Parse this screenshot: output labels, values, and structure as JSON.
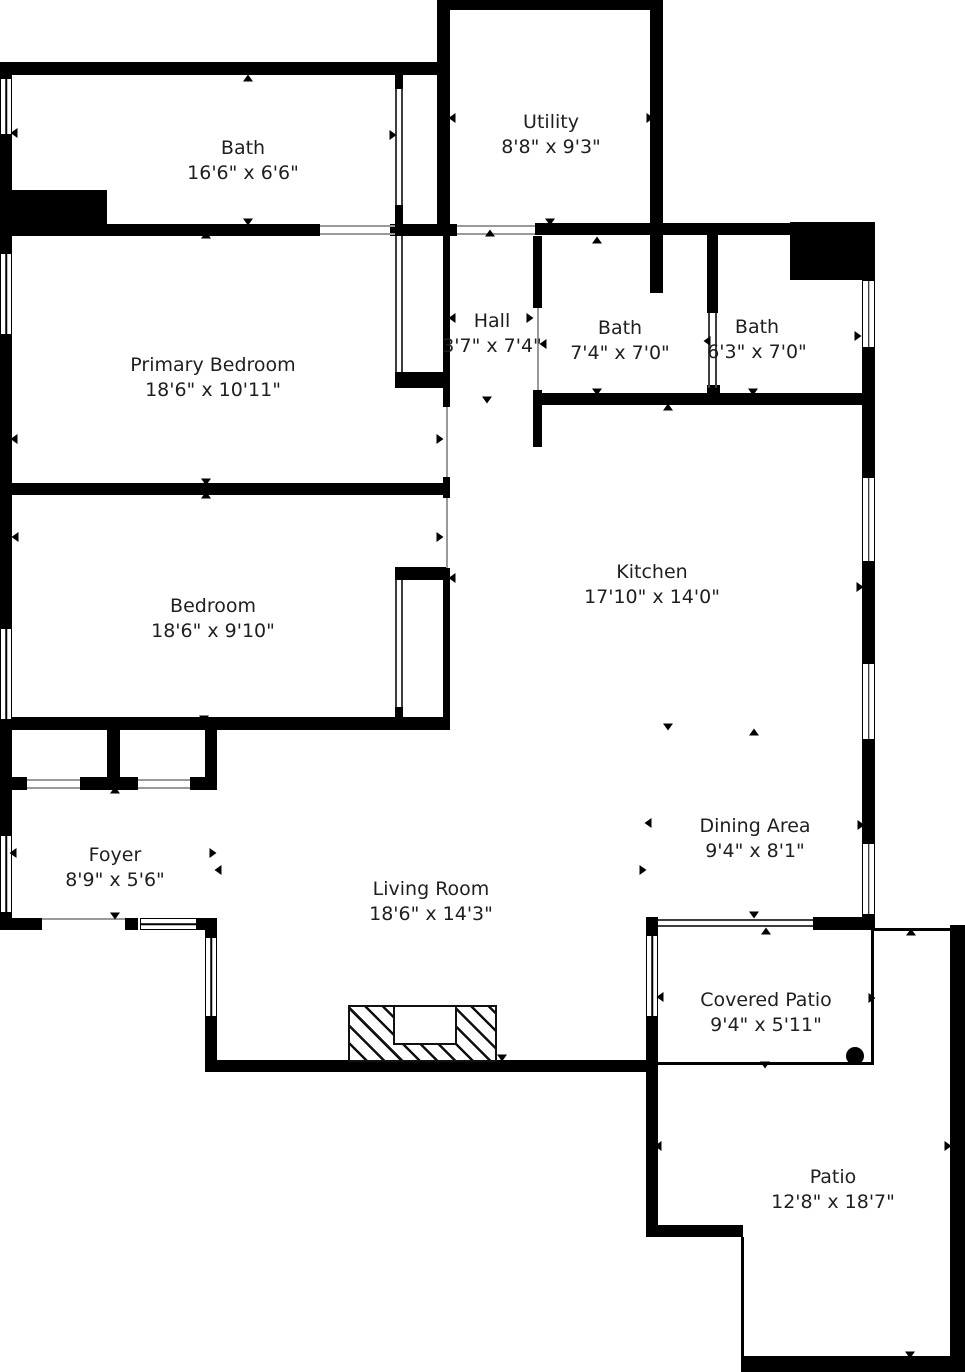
{
  "plan": {
    "width": 965,
    "height": 1372,
    "background_color": "#ffffff",
    "wall_color": "#000000",
    "label_color": "#1f1f1f"
  },
  "rooms": [
    {
      "name": "Bath",
      "dims": "16'6\" x 6'6\"",
      "cx": 243,
      "cy": 161
    },
    {
      "name": "Utility",
      "dims": "8'8\" x 9'3\"",
      "cx": 551,
      "cy": 135
    },
    {
      "name": "Primary Bedroom",
      "dims": "18'6\" x 10'11\"",
      "cx": 213,
      "cy": 378
    },
    {
      "name": "Hall",
      "dims": "3'7\" x 7'4\"",
      "cx": 492,
      "cy": 334
    },
    {
      "name": "Bath",
      "dims": "7'4\" x 7'0\"",
      "cx": 620,
      "cy": 341
    },
    {
      "name": "Bath",
      "dims": "6'3\" x 7'0\"",
      "cx": 757,
      "cy": 340
    },
    {
      "name": "Bedroom",
      "dims": "18'6\" x 9'10\"",
      "cx": 213,
      "cy": 619
    },
    {
      "name": "Kitchen",
      "dims": "17'10\" x 14'0\"",
      "cx": 652,
      "cy": 585
    },
    {
      "name": "Dining Area",
      "dims": "9'4\" x 8'1\"",
      "cx": 755,
      "cy": 839
    },
    {
      "name": "Foyer",
      "dims": "8'9\" x 5'6\"",
      "cx": 115,
      "cy": 868
    },
    {
      "name": "Living Room",
      "dims": "18'6\" x 14'3\"",
      "cx": 431,
      "cy": 902
    },
    {
      "name": "Covered Patio",
      "dims": "9'4\" x 5'11\"",
      "cx": 766,
      "cy": 1013
    },
    {
      "name": "Patio",
      "dims": "12'8\" x 18'7\"",
      "cx": 833,
      "cy": 1190
    }
  ],
  "geometry": {
    "walls": [
      [
        437,
        0,
        226,
        10
      ],
      [
        437,
        0,
        13,
        235
      ],
      [
        650,
        0,
        13,
        235
      ],
      [
        0,
        62,
        443,
        13
      ],
      [
        0,
        62,
        12,
        868
      ],
      [
        0,
        190,
        107,
        35
      ],
      [
        0,
        224,
        320,
        12
      ],
      [
        390,
        224,
        67,
        12
      ],
      [
        535,
        223,
        338,
        12
      ],
      [
        790,
        222,
        83,
        58
      ],
      [
        862,
        222,
        13,
        708
      ],
      [
        395,
        75,
        8,
        14
      ],
      [
        395,
        205,
        8,
        31
      ],
      [
        395,
        372,
        53,
        16
      ],
      [
        443,
        236,
        7,
        171
      ],
      [
        443,
        477,
        7,
        21
      ],
      [
        443,
        568,
        7,
        162
      ],
      [
        0,
        483,
        450,
        12
      ],
      [
        395,
        567,
        53,
        13
      ],
      [
        395,
        707,
        8,
        21
      ],
      [
        0,
        717,
        450,
        13
      ],
      [
        107,
        728,
        13,
        62
      ],
      [
        205,
        728,
        12,
        62
      ],
      [
        12,
        777,
        15,
        13
      ],
      [
        80,
        777,
        58,
        13
      ],
      [
        190,
        777,
        27,
        13
      ],
      [
        0,
        918,
        42,
        12
      ],
      [
        125,
        918,
        13,
        12
      ],
      [
        197,
        918,
        20,
        12
      ],
      [
        205,
        930,
        12,
        142
      ],
      [
        205,
        1060,
        453,
        12
      ],
      [
        533,
        236,
        9,
        72
      ],
      [
        533,
        390,
        9,
        57
      ],
      [
        533,
        393,
        340,
        12
      ],
      [
        650,
        235,
        13,
        58
      ],
      [
        707,
        235,
        11,
        78
      ],
      [
        707,
        385,
        13,
        20
      ],
      [
        813,
        917,
        60,
        13
      ],
      [
        646,
        917,
        12,
        18
      ],
      [
        646,
        1017,
        12,
        220
      ],
      [
        646,
        1225,
        97,
        12
      ],
      [
        741,
        1356,
        224,
        16
      ],
      [
        950,
        925,
        15,
        447
      ]
    ],
    "boundary_lines": [
      [
        871,
        930,
        3,
        134
      ],
      [
        658,
        1062,
        216,
        3
      ],
      [
        874,
        928,
        76,
        3
      ],
      [
        741,
        1237,
        3,
        119
      ]
    ],
    "door_lines": [
      [
        42,
        918,
        83,
        2
      ],
      [
        320,
        225,
        75,
        2
      ],
      [
        320,
        233,
        75,
        2
      ],
      [
        457,
        225,
        78,
        2
      ],
      [
        457,
        233,
        78,
        2
      ],
      [
        446,
        407,
        2,
        70
      ],
      [
        446,
        498,
        2,
        70
      ],
      [
        537,
        308,
        2,
        82
      ],
      [
        27,
        779,
        53,
        2
      ],
      [
        27,
        787,
        53,
        2
      ],
      [
        138,
        779,
        52,
        2
      ],
      [
        138,
        787,
        52,
        2
      ]
    ],
    "slider_lines": [
      [
        658,
        919,
        155,
        2
      ],
      [
        658,
        925,
        155,
        2
      ],
      [
        395,
        89,
        2,
        116
      ],
      [
        401,
        89,
        2,
        116
      ],
      [
        395,
        236,
        2,
        136
      ],
      [
        401,
        236,
        2,
        136
      ],
      [
        395,
        580,
        2,
        127
      ],
      [
        401,
        580,
        2,
        127
      ],
      [
        708,
        313,
        2,
        75
      ],
      [
        715,
        313,
        2,
        75
      ]
    ],
    "windows": [
      {
        "x": 0,
        "y": 78,
        "w": 12,
        "h": 57,
        "o": "v"
      },
      {
        "x": 0,
        "y": 253,
        "w": 12,
        "h": 82,
        "o": "v"
      },
      {
        "x": 0,
        "y": 628,
        "w": 12,
        "h": 92,
        "o": "v"
      },
      {
        "x": 0,
        "y": 835,
        "w": 12,
        "h": 78,
        "o": "v"
      },
      {
        "x": 140,
        "y": 918,
        "w": 57,
        "h": 12,
        "o": "h"
      },
      {
        "x": 205,
        "y": 937,
        "w": 12,
        "h": 80,
        "o": "v"
      },
      {
        "x": 646,
        "y": 935,
        "w": 12,
        "h": 82,
        "o": "v"
      },
      {
        "x": 862,
        "y": 280,
        "w": 13,
        "h": 68,
        "o": "v"
      },
      {
        "x": 862,
        "y": 477,
        "w": 13,
        "h": 85,
        "o": "v"
      },
      {
        "x": 862,
        "y": 663,
        "w": 13,
        "h": 77,
        "o": "v"
      },
      {
        "x": 862,
        "y": 843,
        "w": 13,
        "h": 72,
        "o": "v"
      }
    ],
    "arrows": [
      [
        248,
        78,
        "up"
      ],
      [
        550,
        6,
        "up"
      ],
      [
        490,
        233,
        "up"
      ],
      [
        597,
        240,
        "up"
      ],
      [
        668,
        407,
        "up"
      ],
      [
        206,
        235,
        "up"
      ],
      [
        206,
        495,
        "up"
      ],
      [
        115,
        790,
        "up"
      ],
      [
        766,
        931,
        "up"
      ],
      [
        754,
        732,
        "up"
      ],
      [
        911,
        932,
        "up"
      ],
      [
        248,
        222,
        "down"
      ],
      [
        550,
        222,
        "down"
      ],
      [
        597,
        392,
        "down"
      ],
      [
        753,
        392,
        "down"
      ],
      [
        206,
        482,
        "down"
      ],
      [
        204,
        719,
        "down"
      ],
      [
        487,
        400,
        "down"
      ],
      [
        668,
        727,
        "down"
      ],
      [
        115,
        916,
        "down"
      ],
      [
        502,
        1058,
        "down"
      ],
      [
        754,
        915,
        "down"
      ],
      [
        765,
        1065,
        "down"
      ],
      [
        910,
        1355,
        "down"
      ],
      [
        14,
        133,
        "left"
      ],
      [
        452,
        118,
        "left"
      ],
      [
        452,
        318,
        "left"
      ],
      [
        543,
        344,
        "left"
      ],
      [
        707,
        341,
        "left"
      ],
      [
        14,
        439,
        "left"
      ],
      [
        15,
        537,
        "left"
      ],
      [
        452,
        578,
        "left"
      ],
      [
        648,
        823,
        "left"
      ],
      [
        218,
        870,
        "left"
      ],
      [
        13,
        853,
        "left"
      ],
      [
        660,
        997,
        "left"
      ],
      [
        658,
        1146,
        "left"
      ],
      [
        393,
        135,
        "right"
      ],
      [
        650,
        118,
        "right"
      ],
      [
        530,
        318,
        "right"
      ],
      [
        858,
        336,
        "right"
      ],
      [
        440,
        439,
        "right"
      ],
      [
        440,
        537,
        "right"
      ],
      [
        860,
        587,
        "right"
      ],
      [
        861,
        825,
        "right"
      ],
      [
        643,
        870,
        "right"
      ],
      [
        213,
        853,
        "right"
      ],
      [
        872,
        998,
        "right"
      ],
      [
        948,
        1146,
        "right"
      ]
    ],
    "fireplace": {
      "x": 348,
      "y": 1005,
      "w": 149,
      "h": 57,
      "inner": {
        "x": 393,
        "y": 1005,
        "w": 64,
        "h": 40
      }
    },
    "patio_dot": {
      "cx": 855,
      "cy": 1056,
      "r": 9
    }
  }
}
